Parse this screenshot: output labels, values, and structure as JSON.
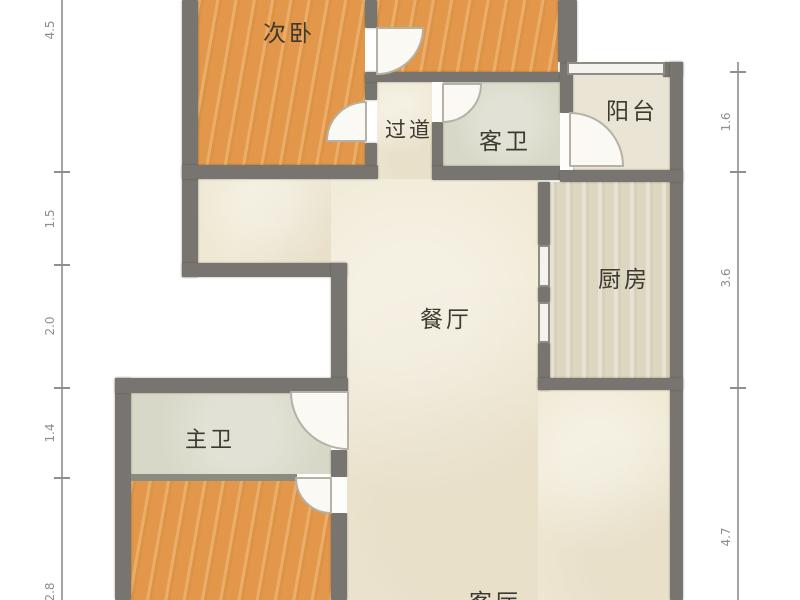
{
  "plan_title": "apartment-floor-plan",
  "rooms": [
    {
      "id": "secondary-bedroom",
      "label": "次卧"
    },
    {
      "id": "hallway",
      "label": "过道"
    },
    {
      "id": "guest-bathroom",
      "label": "客卫"
    },
    {
      "id": "balcony",
      "label": "阳台"
    },
    {
      "id": "kitchen",
      "label": "厨房"
    },
    {
      "id": "dining-room",
      "label": "餐厅"
    },
    {
      "id": "master-bathroom",
      "label": "主卫"
    },
    {
      "id": "living-room",
      "label": "客厅"
    }
  ],
  "dimensions": {
    "left": [
      {
        "value": "4.5"
      },
      {
        "value": "1.5"
      },
      {
        "value": "2.0"
      },
      {
        "value": "1.4"
      },
      {
        "value": "2.8"
      }
    ],
    "right": [
      {
        "value": "1.6"
      },
      {
        "value": "3.6"
      },
      {
        "value": "4.7"
      }
    ]
  },
  "colors": {
    "wall": "#787570",
    "bedroom_floor": "#e2974a",
    "hall_floor": "#efe8d3",
    "bathroom_floor": "#d7d8c7",
    "balcony_floor": "#eae4d4",
    "kitchen_floor": "#ddd7c1",
    "label_text": "#3d3a31",
    "dimension_text": "#8f8f8f",
    "background": "#ffffff"
  }
}
